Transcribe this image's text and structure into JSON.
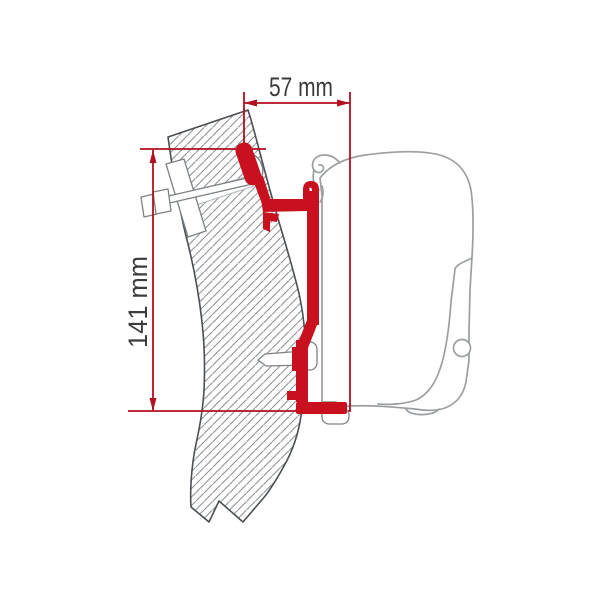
{
  "diagram": {
    "type": "awning-adapter-bracket-profile",
    "labels": {
      "width_dimension": "57 mm",
      "height_dimension": "141 mm"
    },
    "colors": {
      "bracket_red": "#c8101e",
      "dimension_red": "#b01020",
      "wall_outline": "#4b4f54",
      "hatch_gray": "#8d9296",
      "case_outline": "#9b9fa2",
      "hardware_outline": "#7d8287",
      "label_text": "#3b3c3e",
      "background": "#ffffff"
    }
  }
}
